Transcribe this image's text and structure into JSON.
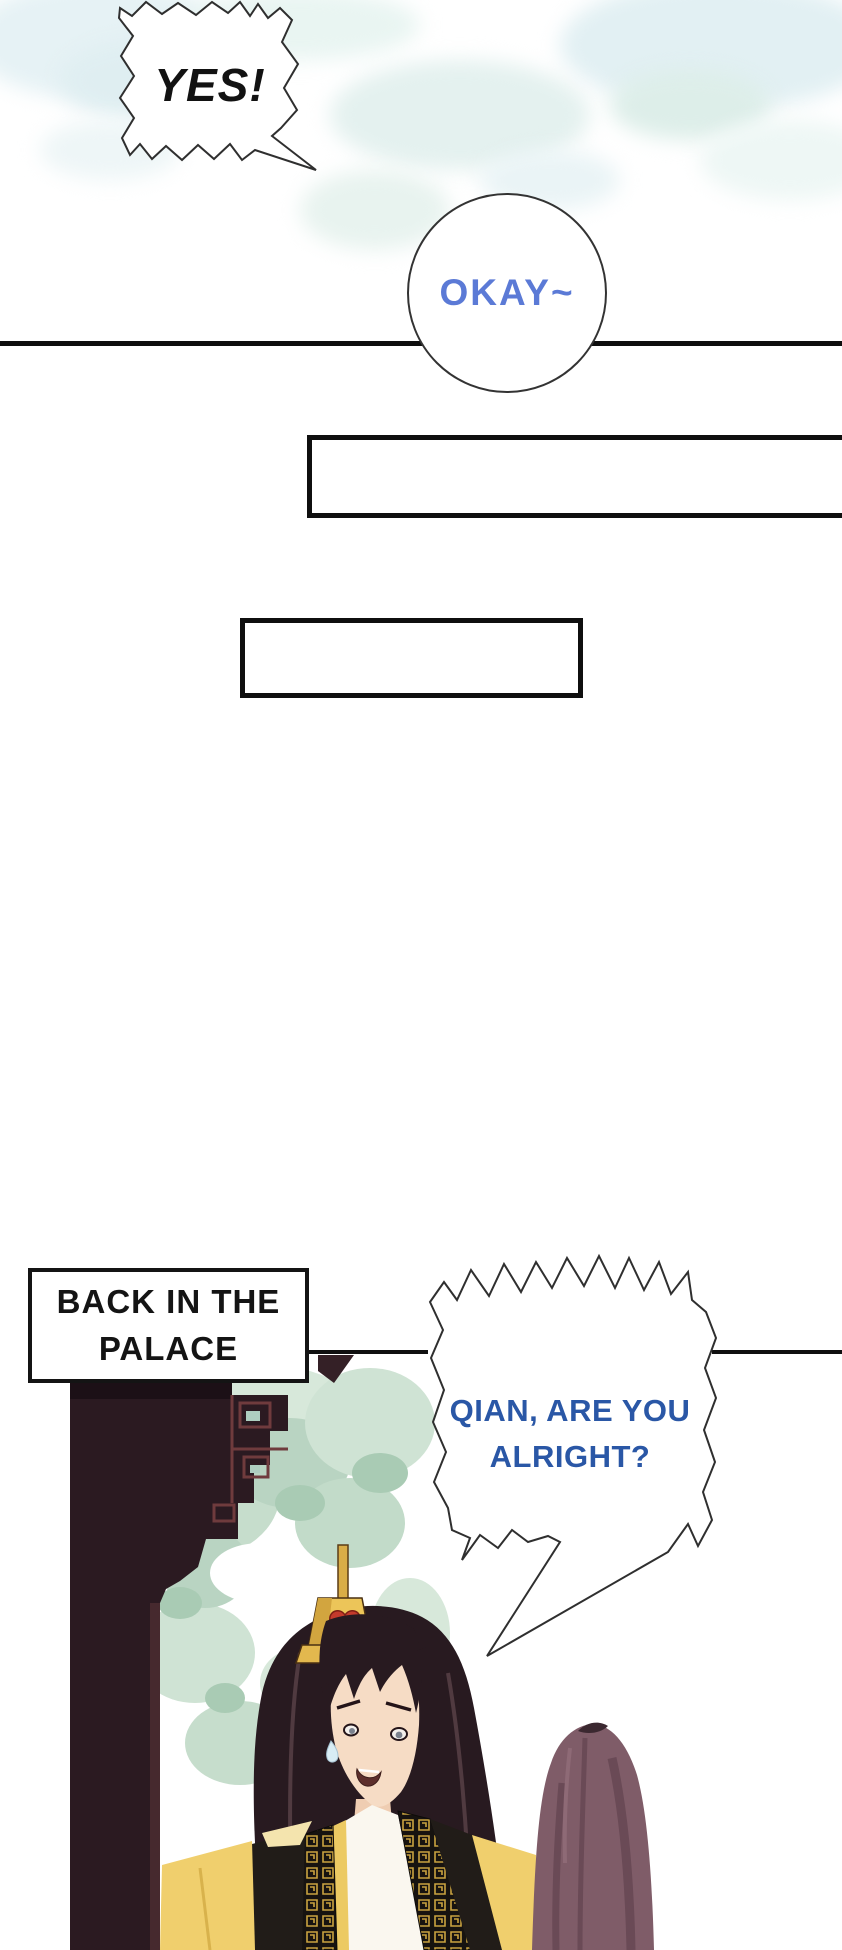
{
  "page": {
    "kind": "comic page",
    "background_color": "#ffffff"
  },
  "speech_bubbles": {
    "yes": {
      "text": "YES!",
      "text_color": "#121212",
      "shape": "jagged-burst"
    },
    "okay": {
      "text": "OKAY~",
      "text_color": "#5b7ad6",
      "shape": "circle"
    },
    "qian": {
      "lines": [
        "QIAN, ARE YOU",
        "ALRIGHT?"
      ],
      "text_color": "#2a57a6",
      "shape": "jagged-burst-with-tail"
    }
  },
  "caption": {
    "lines": [
      "BACK IN THE",
      "PALACE"
    ],
    "text_color": "#141414",
    "border_color": "#141414"
  },
  "scene": {
    "description_icons": [
      "palace-pillar",
      "palace-bracket",
      "foliage",
      "emperor-figure",
      "empress-figure"
    ]
  },
  "colors": {
    "divider_black": "#0e0e0e",
    "cloud_blue": "#e3f1f4",
    "cloud_mint": "#e1efe8",
    "foliage_green": "#c6ddcc",
    "wood_dark": "#2b1a21",
    "wood_red_lattice": "#6f3b3d",
    "robe_gold": "#f0cf6d",
    "crown_gold": "#ecc559",
    "gem_red": "#c43a2c",
    "hair_dark": "#281a20",
    "empress_hair_plum": "#7f5c68",
    "skin": "#f6dcc5"
  }
}
